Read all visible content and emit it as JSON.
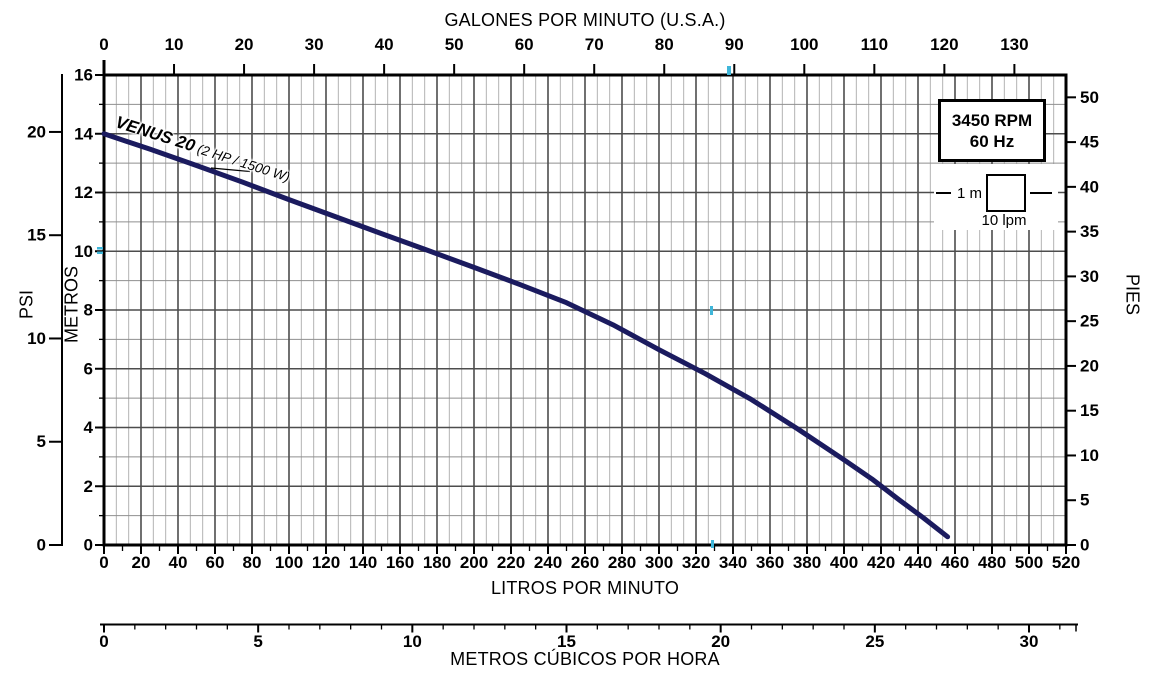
{
  "chart_data": {
    "type": "line",
    "series": [
      {
        "name": "VENUS 20",
        "label": "VENUS 20",
        "sublabel": " (2 HP / 1500 W)",
        "points_lpm_m": [
          [
            0,
            14.0
          ],
          [
            25,
            13.47
          ],
          [
            50,
            12.92
          ],
          [
            75,
            12.35
          ],
          [
            100,
            11.76
          ],
          [
            125,
            11.18
          ],
          [
            150,
            10.6
          ],
          [
            175,
            10.03
          ],
          [
            200,
            9.45
          ],
          [
            225,
            8.86
          ],
          [
            250,
            8.25
          ],
          [
            275,
            7.5
          ],
          [
            300,
            6.65
          ],
          [
            325,
            5.83
          ],
          [
            350,
            4.95
          ],
          [
            375,
            3.95
          ],
          [
            400,
            2.9
          ],
          [
            415,
            2.25
          ],
          [
            430,
            1.53
          ],
          [
            443,
            0.92
          ],
          [
            456,
            0.28
          ]
        ]
      }
    ],
    "axes": {
      "gpm": {
        "title": "GALONES POR MINUTO (U.S.A.)",
        "ticks": [
          0,
          10,
          20,
          30,
          40,
          50,
          60,
          70,
          80,
          90,
          100,
          110,
          120,
          130
        ],
        "position": "top"
      },
      "lpm": {
        "title": "LITROS POR MINUTO",
        "ticks": [
          0,
          20,
          40,
          60,
          80,
          100,
          120,
          140,
          160,
          180,
          200,
          220,
          240,
          260,
          280,
          300,
          320,
          340,
          360,
          380,
          400,
          420,
          440,
          460,
          480,
          500,
          520
        ],
        "minor_step": 10,
        "range": [
          0,
          520
        ],
        "position": "bottom"
      },
      "m3h": {
        "title": "METROS CÚBICOS POR HORA",
        "ticks": [
          0,
          5,
          10,
          15,
          20,
          25,
          30
        ],
        "minor_step": 1,
        "position": "bottom-secondary"
      },
      "metros": {
        "title": "METROS",
        "ticks": [
          0,
          2,
          4,
          6,
          8,
          10,
          12,
          14,
          16
        ],
        "range": [
          0,
          16
        ],
        "position": "left"
      },
      "psi": {
        "title": "PSI",
        "ticks": [
          0,
          5,
          10,
          15,
          20
        ],
        "position": "far-left"
      },
      "pies": {
        "title": "PIES",
        "ticks": [
          0,
          5,
          10,
          15,
          20,
          25,
          30,
          35,
          40,
          45,
          50
        ],
        "position": "right"
      }
    },
    "legend": {
      "line1": "3450 RPM",
      "line2": "60 Hz"
    },
    "scale_indicator": {
      "height_label": "1 m",
      "width_label": "10 lpm"
    },
    "grid": {
      "major_x_lpm": 20,
      "minor_x_divisions": 3,
      "major_y_m": 2,
      "medium_y_m": 1
    },
    "colors": {
      "curve": "#1b1b5f",
      "grid_major": "#4d4d4d",
      "grid_medium": "#8f8f8f",
      "grid_minor": "#b3b3b3",
      "axis": "#000000",
      "registration_mark": "#3fb6d9"
    }
  }
}
